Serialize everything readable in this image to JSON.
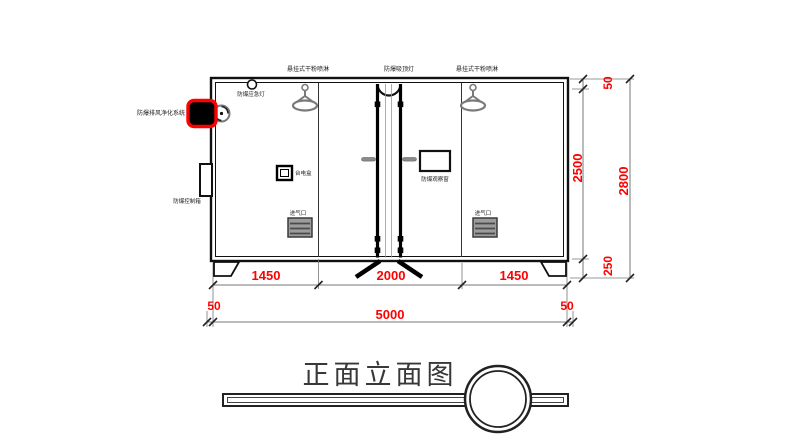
{
  "title": "正面立面图",
  "colors": {
    "dimension": "#ff0000",
    "highlight": "#ff0000",
    "line": "#1a1a1a",
    "gray": "#7a7a7a"
  },
  "components": {
    "sprinkler_left": "悬挂式干粉喷淋",
    "ceiling_lamp": "防爆吸顶灯",
    "sprinkler_right": "悬挂式干粉喷淋",
    "emergency_light": "防爆应急灯",
    "ventilation_system": "防爆排风净化系统",
    "control_box": "防爆控制箱",
    "junction_box": "台电盒",
    "observation_window": "防爆观察窗",
    "air_inlet_left": "进气口",
    "air_inlet_right": "进气口"
  },
  "dimensions": {
    "width_left_panel": "1450",
    "width_center": "2000",
    "width_right_panel": "1450",
    "overhang_left": "50",
    "total_width": "5000",
    "overhang_right": "50",
    "roof_thickness": "50",
    "body_height": "2500",
    "base_height": "250",
    "total_height": "2800"
  }
}
